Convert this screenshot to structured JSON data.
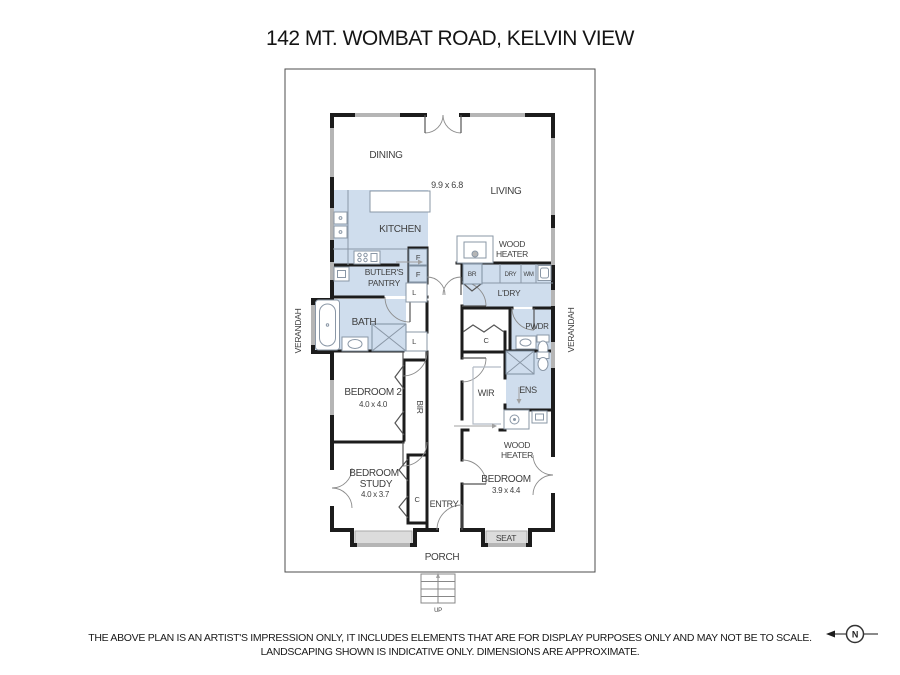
{
  "title": "142 MT. WOMBAT ROAD, KELVIN VIEW",
  "floor_plan": {
    "overall_dims": "9.9 x 6.8",
    "rooms": {
      "dining": "DINING",
      "living": "LIVING",
      "kitchen": "KITCHEN",
      "butlers_pantry_line1": "BUTLER'S",
      "butlers_pantry_line2": "PANTRY",
      "bath": "BATH",
      "laundry": "L'DRY",
      "powder": "PWDR",
      "bedroom2": "BEDROOM 2",
      "bedroom2_dims": "4.0 x 4.0",
      "wir": "WIR",
      "ensuite": "ENS",
      "bedroom_study_line1": "BEDROOM",
      "bedroom_study_line2": "STUDY",
      "bedroom_study_dims": "4.0 x 3.7",
      "bedroom": "BEDROOM",
      "bedroom_dims": "3.9 x 4.4",
      "entry": "ENTRY",
      "porch": "PORCH"
    },
    "outdoor": {
      "verandah": "VERANDAH",
      "seat": "SEAT",
      "up": "UP"
    },
    "features": {
      "wood_heater_line1": "WOOD",
      "wood_heater_line2": "HEATER",
      "built_in_robe": "BIR",
      "fridge": "F",
      "linen": "L",
      "closet": "C",
      "broom": "BR",
      "dryer": "DRY",
      "washing_machine": "WM"
    }
  },
  "compass": {
    "north": "N"
  },
  "disclaimer": {
    "line1": "THE ABOVE PLAN IS AN ARTIST'S IMPRESSION ONLY, IT INCLUDES ELEMENTS THAT ARE FOR DISPLAY PURPOSES ONLY AND MAY NOT BE TO SCALE.",
    "line2": "LANDSCAPING SHOWN IS INDICATIVE ONLY. DIMENSIONS ARE APPROXIMATE."
  },
  "colors": {
    "room_fill": "#cfdded",
    "wall": "#1c1c1c",
    "window_gray": "#b5b5b5",
    "label_text": "#3f3f3f"
  }
}
